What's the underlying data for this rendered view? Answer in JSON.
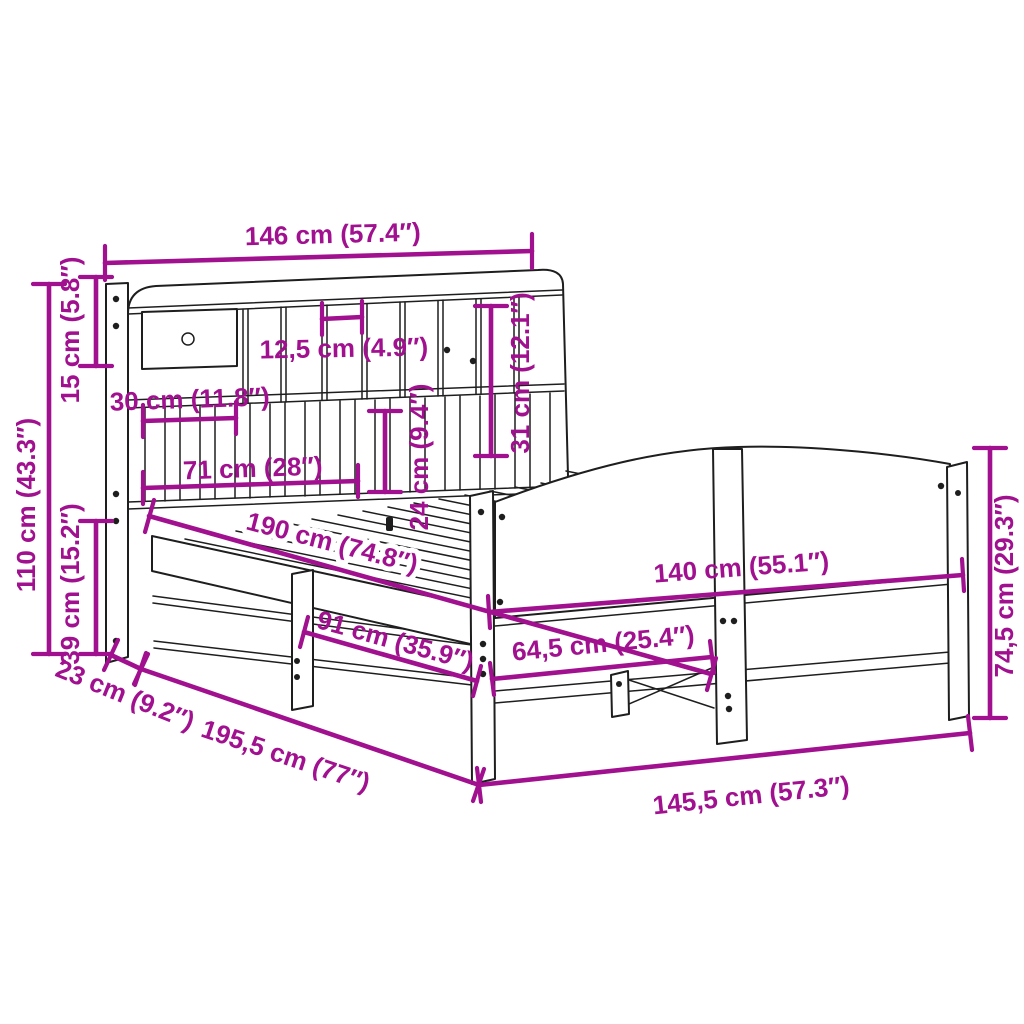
{
  "figure": {
    "kind": "product-dimension-diagram",
    "subject": "bed frame with bookcase headboard and curved footboard"
  },
  "colors": {
    "dimension": "#A0108F",
    "line": "#1e1e1e",
    "background": "#ffffff"
  },
  "dims": {
    "w146": {
      "label": "146 cm (57.4″)",
      "cm": 146,
      "inch": 57.4
    },
    "h110": {
      "label": "110 cm (43.3″)",
      "cm": 110,
      "inch": 43.3
    },
    "h15": {
      "label": "15 cm (5.8″)",
      "cm": 15,
      "inch": 5.8
    },
    "h39": {
      "label": "39 cm (15.2″)",
      "cm": 39,
      "inch": 15.2
    },
    "w12_5": {
      "label": "12,5 cm (4.9″)",
      "cm": 12.5,
      "inch": 4.9
    },
    "w30": {
      "label": "30 cm (11.8″)",
      "cm": 30,
      "inch": 11.8
    },
    "w71": {
      "label": "71 cm (28″)",
      "cm": 71,
      "inch": 28
    },
    "h31": {
      "label": "31 cm (12.1″)",
      "cm": 31,
      "inch": 12.1
    },
    "h24": {
      "label": "24 cm (9.4″)",
      "cm": 24,
      "inch": 9.4
    },
    "l190": {
      "label": "190 cm (74.8″)",
      "cm": 190,
      "inch": 74.8
    },
    "w140": {
      "label": "140 cm (55.1″)",
      "cm": 140,
      "inch": 55.1
    },
    "l91": {
      "label": "91 cm (35.9″)",
      "cm": 91,
      "inch": 35.9
    },
    "l64_5": {
      "label": "64,5 cm (25.4″)",
      "cm": 64.5,
      "inch": 25.4
    },
    "d23": {
      "label": "23 cm (9.2″)",
      "cm": 23,
      "inch": 9.2
    },
    "l195_5": {
      "label": "195,5 cm (77″)",
      "cm": 195.5,
      "inch": 77
    },
    "w145_5": {
      "label": "145,5 cm (57.3″)",
      "cm": 145.5,
      "inch": 57.3
    },
    "h74_5": {
      "label": "74,5 cm (29.3″)",
      "cm": 74.5,
      "inch": 29.3
    }
  }
}
